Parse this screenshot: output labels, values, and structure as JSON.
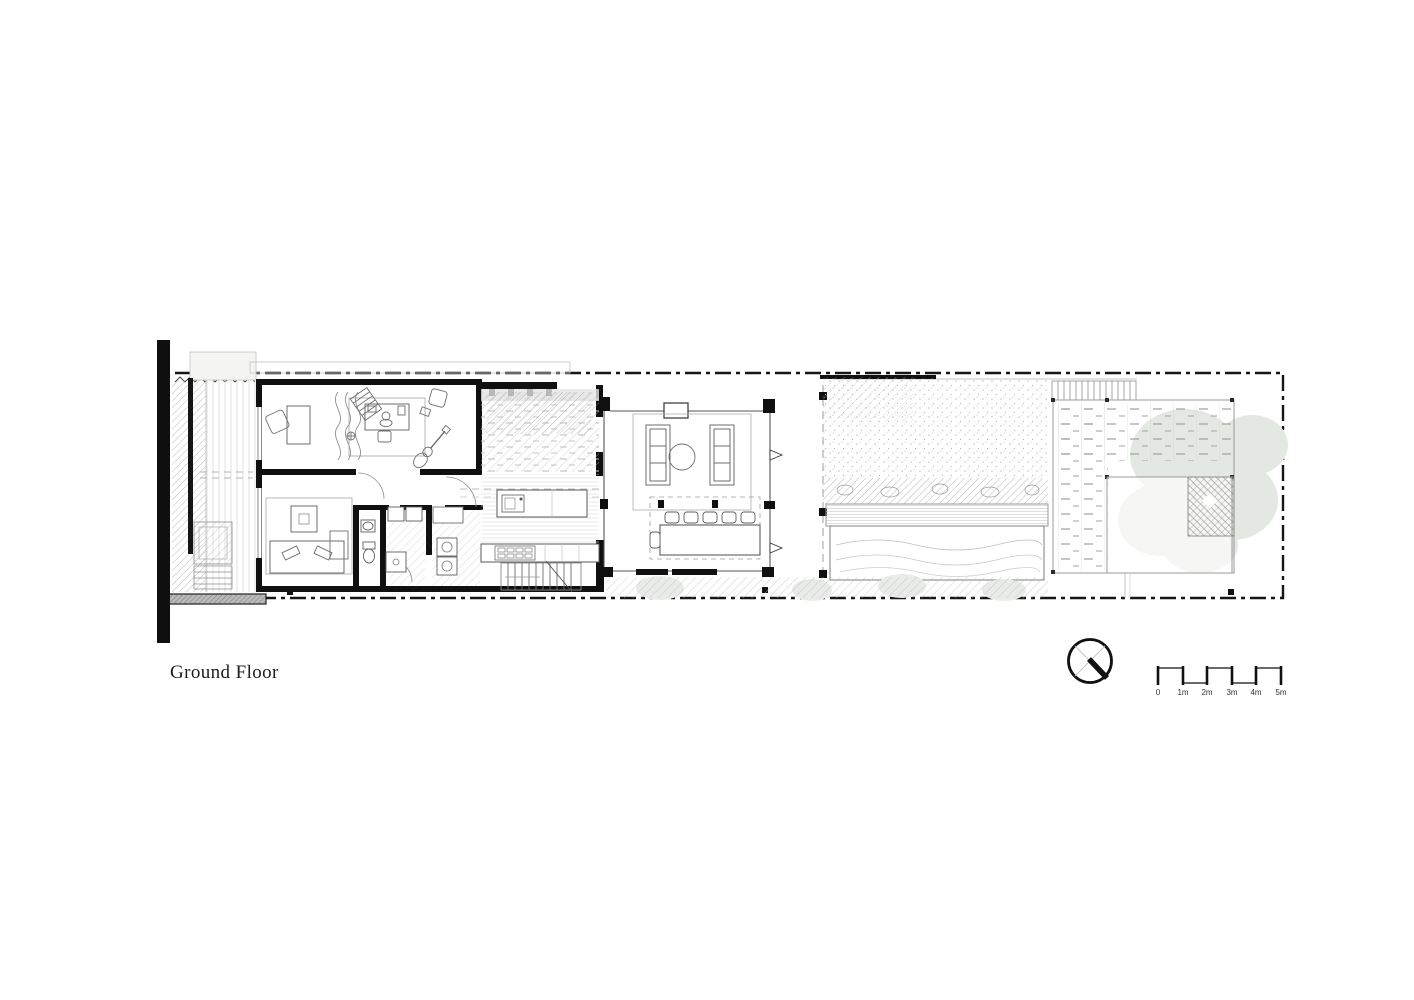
{
  "title_block": {
    "title": "Ground Floor"
  },
  "scale_bar": {
    "labels": [
      "0",
      "1m",
      "2m",
      "3m",
      "4m",
      "5m"
    ]
  },
  "icons": {
    "north_arrow": "north-arrow-compass"
  },
  "colors": {
    "ink": "#1b1b1b",
    "wall": "#111111",
    "line_medium": "#666666",
    "line_light": "#bbbbbb",
    "fill_light": "#f3f3f1",
    "foliage": "#e4e8e2",
    "water": "#ffffff"
  }
}
